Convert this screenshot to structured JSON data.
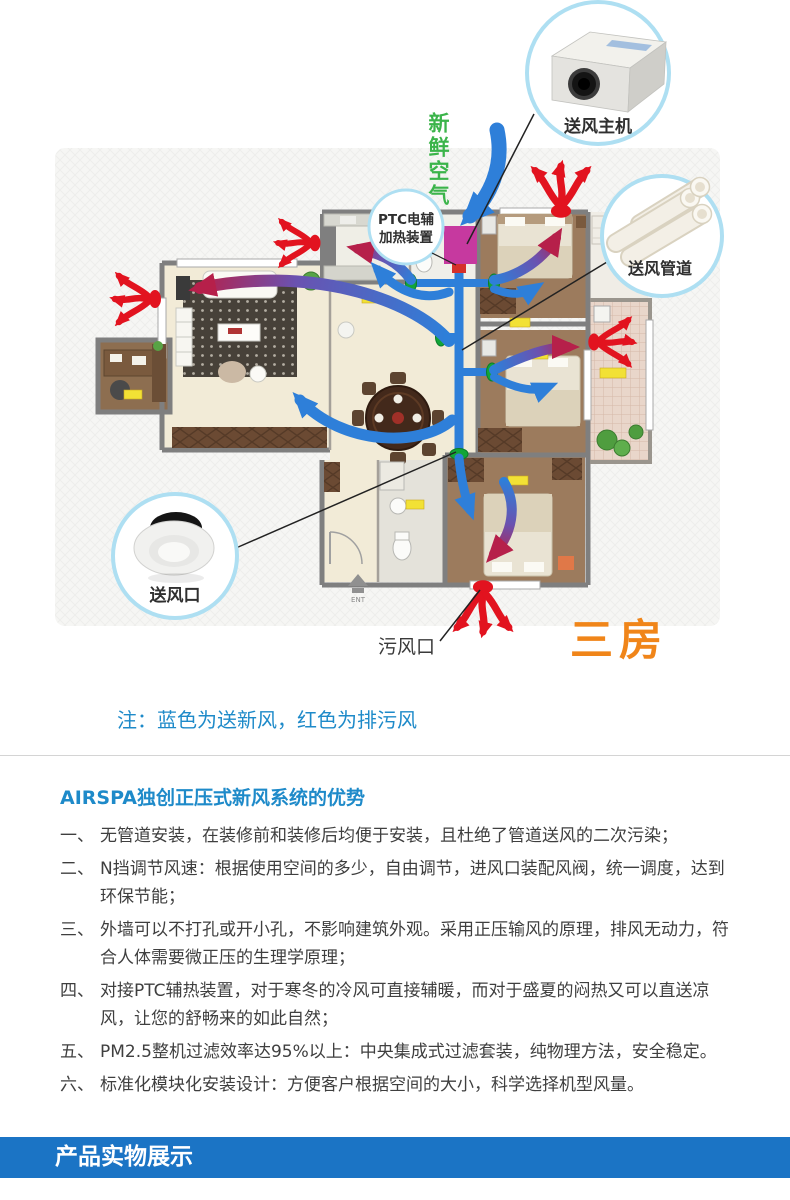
{
  "diagram": {
    "fresh_air": "新鲜空气",
    "ptc_line1": "PTC电辅",
    "ptc_line2": "加热装置",
    "supply_unit": "送风主机",
    "supply_duct": "送风管道",
    "supply_outlet": "送风口",
    "exhaust_outlet": "污风口",
    "apartment_type": "三房",
    "entrance": "ENT",
    "note": "注：蓝色为送新风，红色为排污风",
    "legend": {
      "blue_means": "送新风",
      "red_means": "排污风"
    },
    "colors": {
      "supply_blue": "#2e7fd9",
      "exhaust_red": "#e2131f",
      "valve_green": "#12a538",
      "fresh_air_green": "#3bb44a",
      "ptc_magenta": "#c6399f",
      "apartment_orange": "#f08519",
      "callout_ring": "#aedff2"
    }
  },
  "advantages": {
    "title": "AIRSPA独创正压式新风系统的优势",
    "items": [
      {
        "num": "一、",
        "text": "无管道安装，在装修前和装修后均便于安装，且杜绝了管道送风的二次污染；"
      },
      {
        "num": "二、",
        "text": "N挡调节风速：根据使用空间的多少，自由调节，进风口装配风阀，统一调度，达到环保节能；"
      },
      {
        "num": "三、",
        "text": "外墙可以不打孔或开小孔，不影响建筑外观。采用正压输风的原理，排风无动力，符合人体需要微正压的生理学原理；"
      },
      {
        "num": "四、",
        "text": "对接PTC辅热装置，对于寒冬的冷风可直接辅暖，而对于盛夏的闷热又可以直送凉风，让您的舒畅来的如此自然；"
      },
      {
        "num": "五、",
        "text": "PM2.5整机过滤效率达95%以上：中央集成式过滤套装，纯物理方法，安全稳定。"
      },
      {
        "num": "六、",
        "text": "标准化模块化安装设计：方便客户根据空间的大小，科学选择机型风量。"
      }
    ]
  },
  "banner": {
    "title": "产品实物展示"
  }
}
